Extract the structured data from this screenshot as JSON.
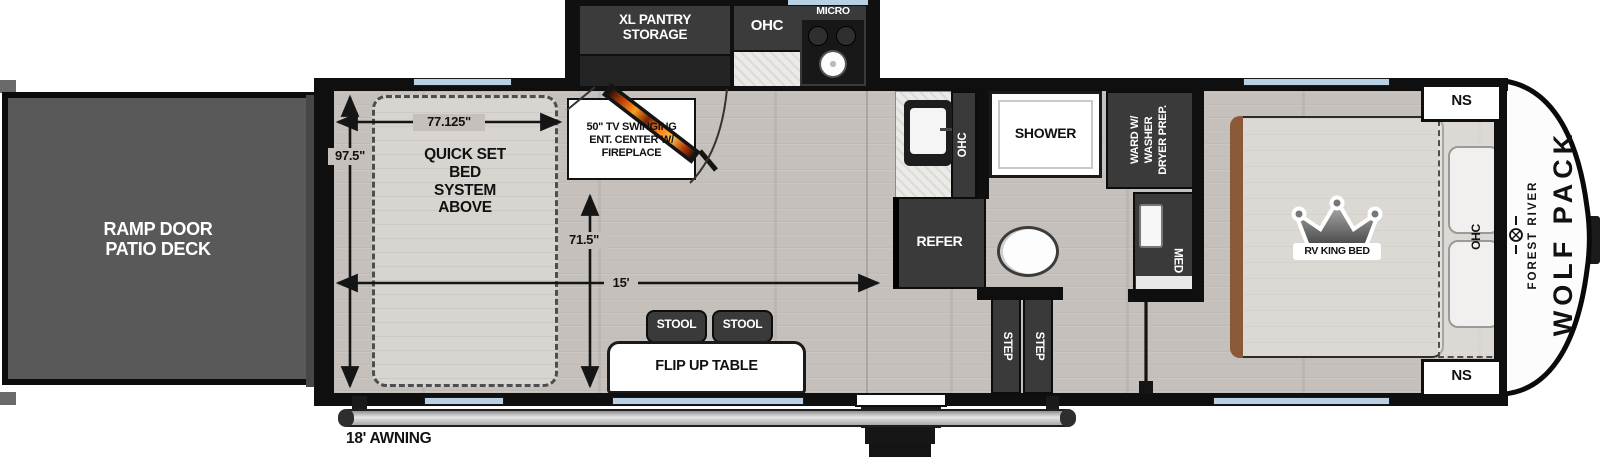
{
  "colors": {
    "window_blue": "#b9cfe4",
    "cabinet_dark": "#3a3a3a",
    "wall_black": "#0f0f0f",
    "deck_gray": "#595959",
    "floor_gray": "#c5c0bb",
    "flame_orange": "#ff8a1e",
    "headboard_brown": "#8a5a38"
  },
  "exterior": {
    "ramp_line1": "RAMP DOOR",
    "ramp_line2": "PATIO DECK",
    "awning": "18' AWNING"
  },
  "garage": {
    "bed_line1": "QUICK SET",
    "bed_line2": "BED",
    "bed_line3": "SYSTEM",
    "bed_line4": "ABOVE",
    "dim_width": "77.125\"",
    "dim_depth": "97.5\"",
    "dim_interior": "71.5\"",
    "dim_length": "15'"
  },
  "kitchen": {
    "pantry_line1": "XL PANTRY",
    "pantry_line2": "STORAGE",
    "ohc": "OHC",
    "micro": "MICRO",
    "counter_ohc": "OHC",
    "refer": "REFER"
  },
  "living": {
    "tv_line1": "50\" TV SWINGING",
    "tv_line2": "ENT. CENTER W/",
    "tv_line3": "FIREPLACE",
    "stool": "STOOL",
    "table": "FLIP UP TABLE"
  },
  "bath": {
    "shower": "SHOWER",
    "ward_line1": "WARD W/",
    "ward_line2": "WASHER",
    "ward_line3": "DRYER PREP.",
    "med": "MED",
    "step": "STEP"
  },
  "bedroom": {
    "bed": "RV KING BED",
    "ns": "NS",
    "ohc": "OHC"
  },
  "brand": {
    "maker": "FOREST RIVER",
    "model": "WOLF PACK"
  }
}
